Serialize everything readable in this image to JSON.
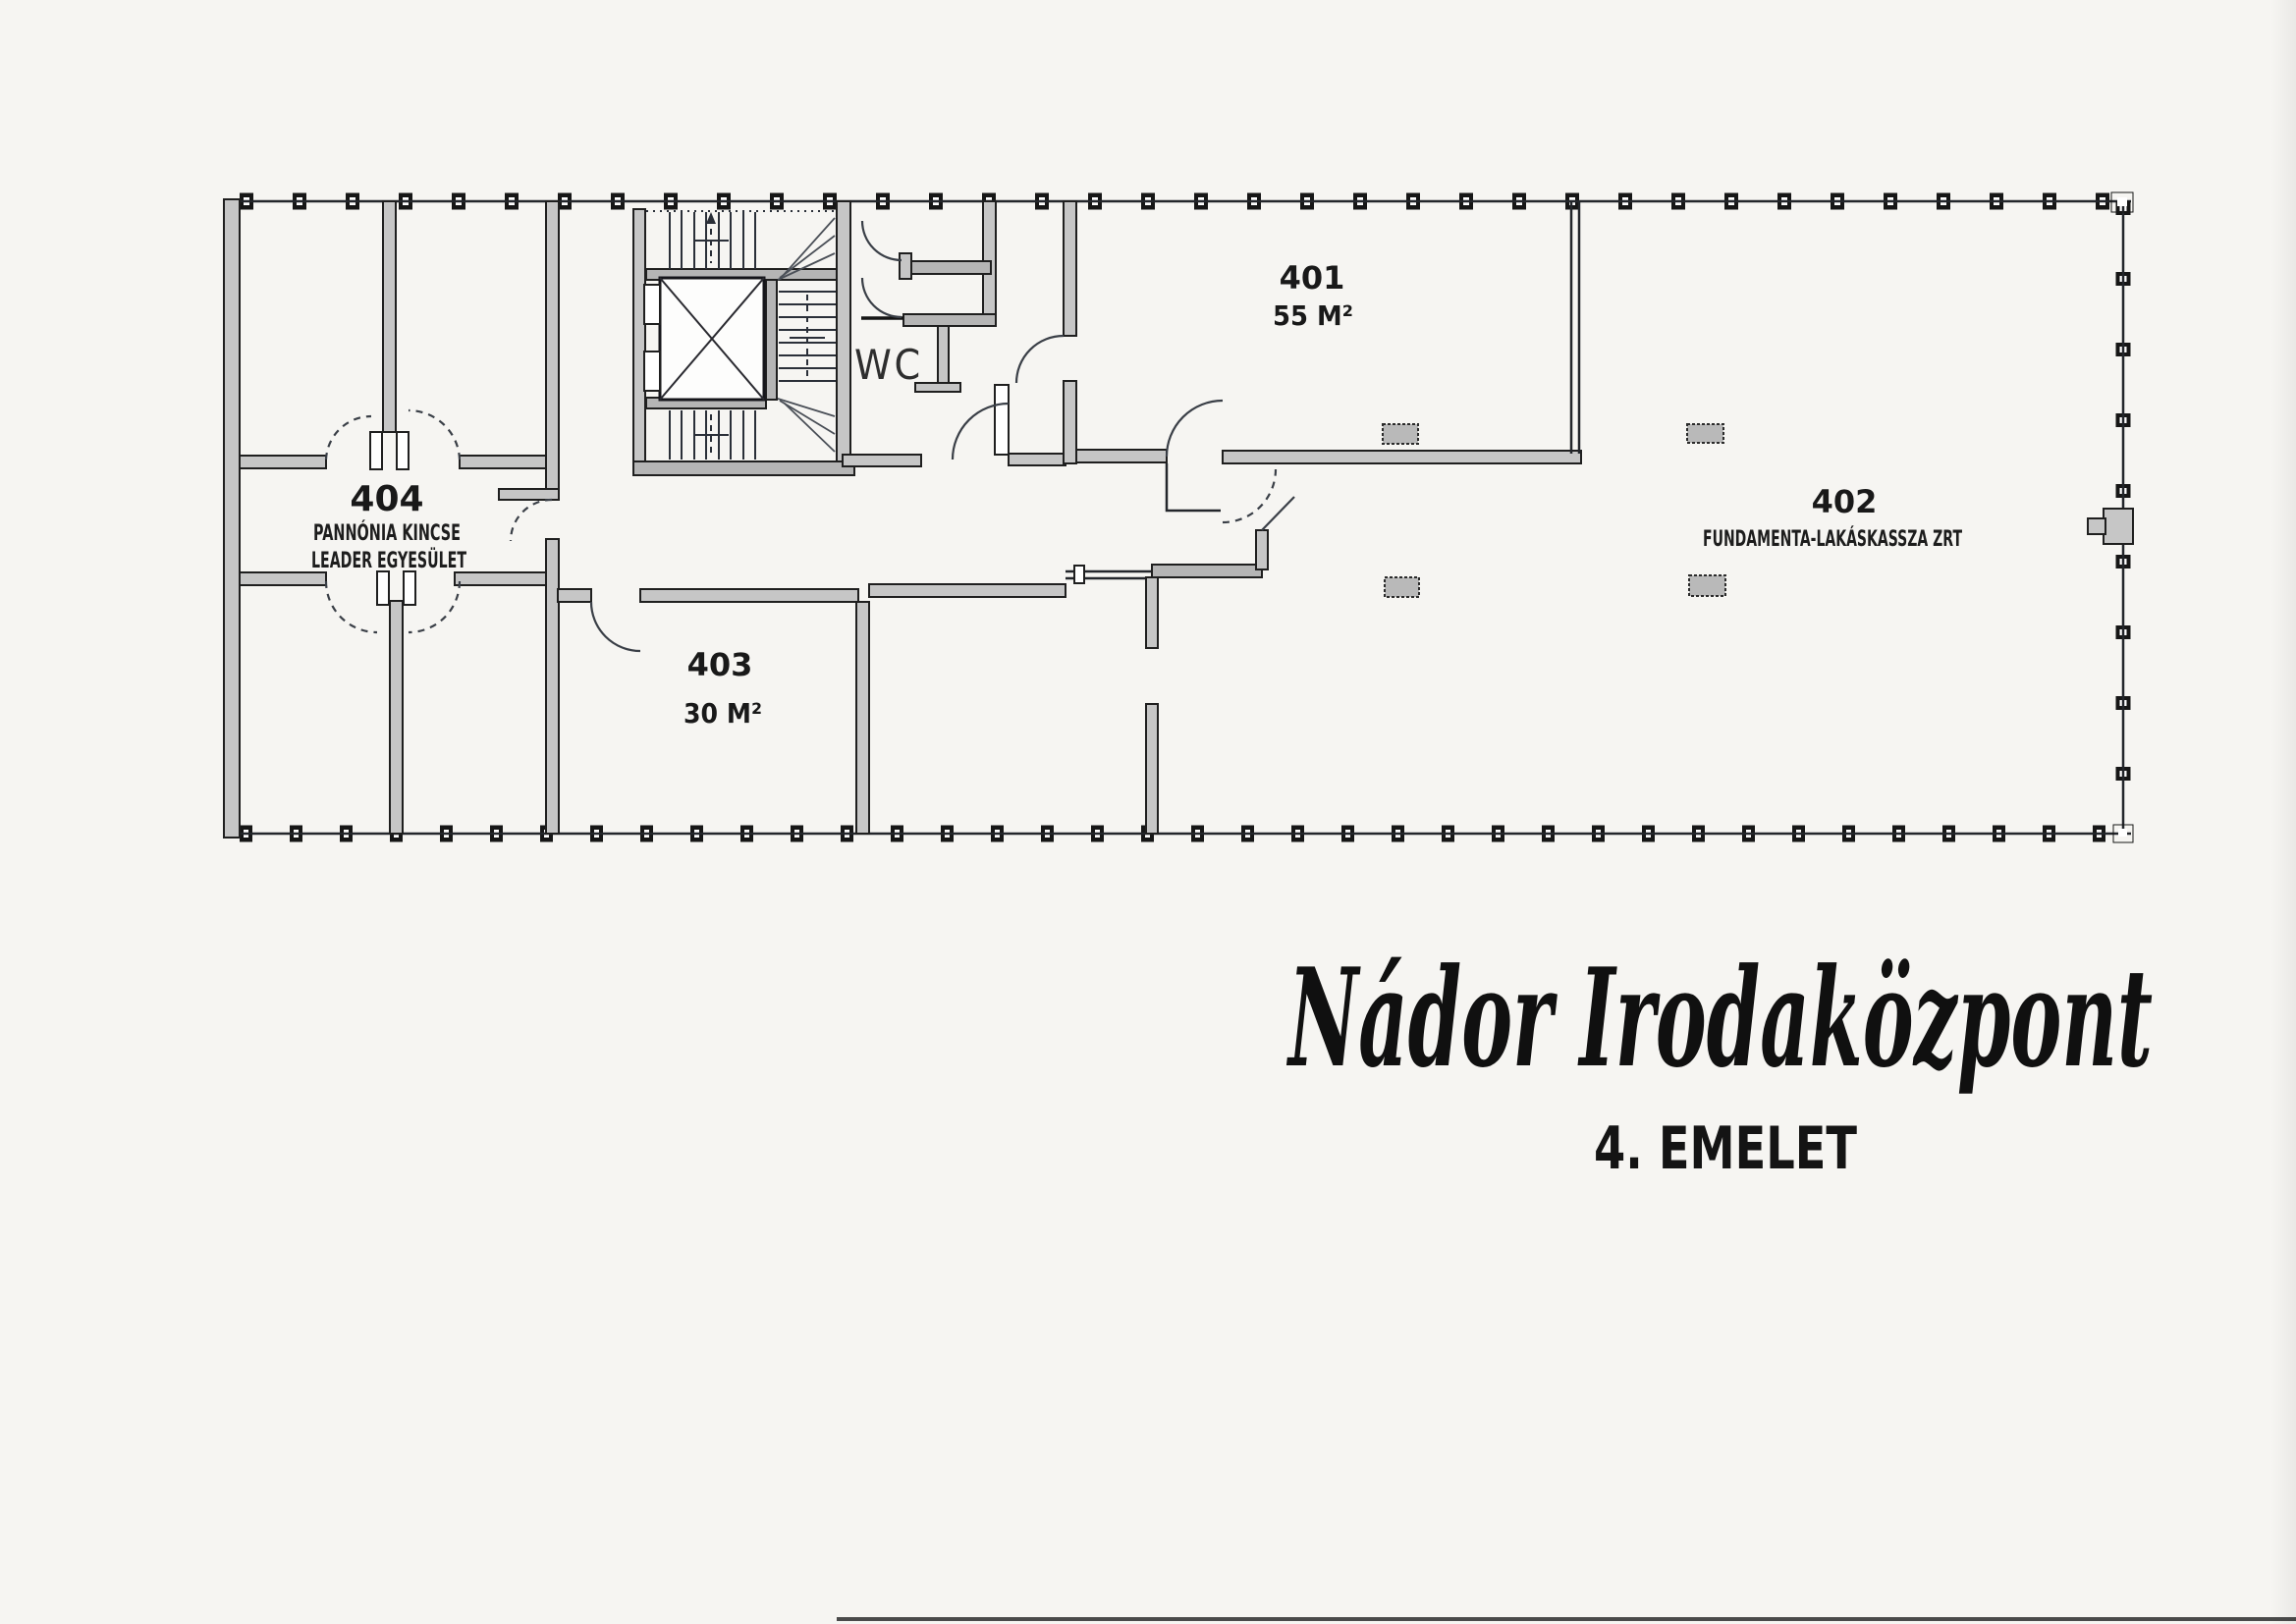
{
  "page": {
    "title": "Nádor Irodaközpont",
    "floor": "4. EMELET"
  },
  "rooms": {
    "r401": {
      "number": "401",
      "area": "55 M²"
    },
    "r402": {
      "number": "402",
      "tenant": "FUNDAMENTA-LAKÁSKASSZA ZRT"
    },
    "r403": {
      "number": "403",
      "area": "30 M²"
    },
    "r404": {
      "number": "404",
      "tenant_line1": "PANNÓNIA KINCSE",
      "tenant_line2": "LEADER EGYESÜLET"
    }
  },
  "labels": {
    "wc": "WC"
  },
  "colors": {
    "paper": "#f6f5f2",
    "wall_fill": "#c6c6c6",
    "line": "#1f1f1f"
  }
}
